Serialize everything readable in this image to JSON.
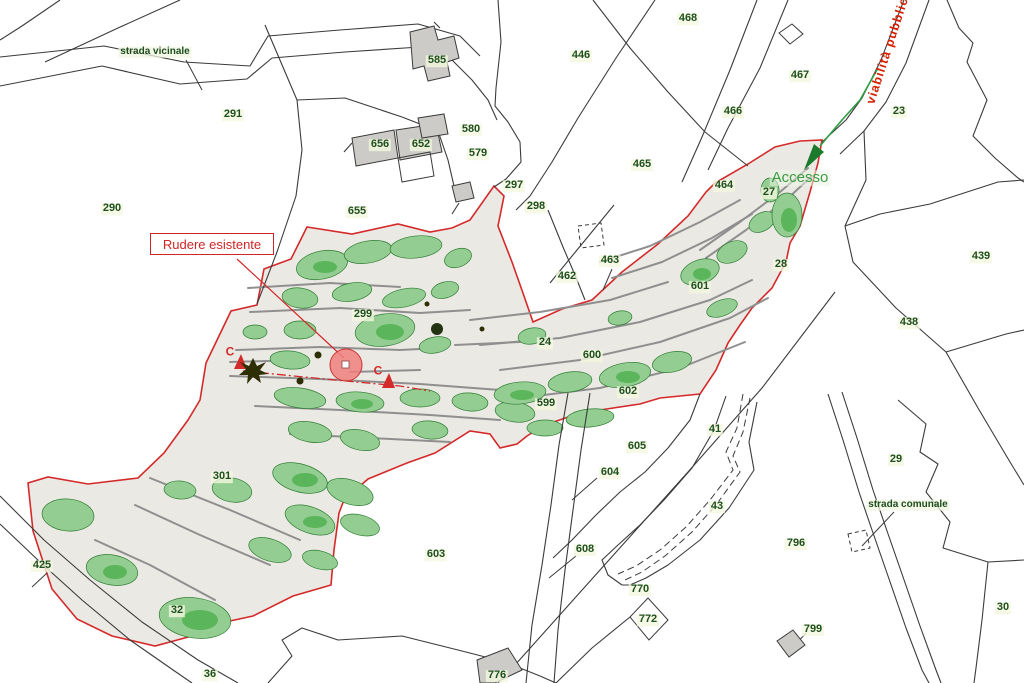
{
  "map": {
    "title": "cadastral-site-plan",
    "colors": {
      "site_boundary": "#d42a2a",
      "site_fill": "#ebe9e4",
      "vegetation": "#93cd92",
      "vegetation_dark": "#5bb55a",
      "parcel_line": "#3b3b3b",
      "terrace_wall": "#8f8f8f",
      "building_fill": "#cccbc7",
      "access_green": "#2f9e44",
      "ruin_marker_fill": "#f1807e"
    },
    "annotation": {
      "ruin_label": "Rudere esistente"
    },
    "labels": [
      {
        "text": "291",
        "x": 233,
        "y": 115,
        "cls": "parcel"
      },
      {
        "text": "290",
        "x": 112,
        "y": 209,
        "cls": "parcel"
      },
      {
        "text": "585",
        "x": 437,
        "y": 61,
        "cls": "parcel"
      },
      {
        "text": "656",
        "x": 380,
        "y": 145,
        "cls": "parcel"
      },
      {
        "text": "652",
        "x": 421,
        "y": 145,
        "cls": "parcel"
      },
      {
        "text": "580",
        "x": 471,
        "y": 130,
        "cls": "parcel"
      },
      {
        "text": "579",
        "x": 478,
        "y": 154,
        "cls": "parcel"
      },
      {
        "text": "297",
        "x": 514,
        "y": 186,
        "cls": "parcel"
      },
      {
        "text": "298",
        "x": 536,
        "y": 207,
        "cls": "parcel"
      },
      {
        "text": "655",
        "x": 357,
        "y": 212,
        "cls": "parcel"
      },
      {
        "text": "468",
        "x": 688,
        "y": 19,
        "cls": "parcel"
      },
      {
        "text": "446",
        "x": 581,
        "y": 56,
        "cls": "parcel"
      },
      {
        "text": "467",
        "x": 800,
        "y": 76,
        "cls": "parcel"
      },
      {
        "text": "466",
        "x": 733,
        "y": 112,
        "cls": "parcel"
      },
      {
        "text": "465",
        "x": 642,
        "y": 165,
        "cls": "parcel"
      },
      {
        "text": "23",
        "x": 899,
        "y": 112,
        "cls": "parcel"
      },
      {
        "text": "464",
        "x": 724,
        "y": 186,
        "cls": "parcel"
      },
      {
        "text": "27",
        "x": 769,
        "y": 193,
        "cls": "parcel"
      },
      {
        "text": "28",
        "x": 781,
        "y": 265,
        "cls": "parcel"
      },
      {
        "text": "439",
        "x": 981,
        "y": 257,
        "cls": "parcel"
      },
      {
        "text": "438",
        "x": 909,
        "y": 323,
        "cls": "parcel"
      },
      {
        "text": "462",
        "x": 567,
        "y": 277,
        "cls": "parcel"
      },
      {
        "text": "463",
        "x": 610,
        "y": 261,
        "cls": "parcel"
      },
      {
        "text": "601",
        "x": 700,
        "y": 287,
        "cls": "parcel"
      },
      {
        "text": "24",
        "x": 545,
        "y": 343,
        "cls": "parcel"
      },
      {
        "text": "600",
        "x": 592,
        "y": 356,
        "cls": "parcel"
      },
      {
        "text": "602",
        "x": 628,
        "y": 392,
        "cls": "parcel"
      },
      {
        "text": "599",
        "x": 546,
        "y": 404,
        "cls": "parcel"
      },
      {
        "text": "299",
        "x": 363,
        "y": 315,
        "cls": "parcel"
      },
      {
        "text": "41",
        "x": 715,
        "y": 430,
        "cls": "parcel"
      },
      {
        "text": "43",
        "x": 717,
        "y": 507,
        "cls": "parcel"
      },
      {
        "text": "605",
        "x": 637,
        "y": 447,
        "cls": "parcel"
      },
      {
        "text": "604",
        "x": 610,
        "y": 473,
        "cls": "parcel"
      },
      {
        "text": "608",
        "x": 585,
        "y": 550,
        "cls": "parcel"
      },
      {
        "text": "603",
        "x": 436,
        "y": 555,
        "cls": "parcel"
      },
      {
        "text": "301",
        "x": 222,
        "y": 477,
        "cls": "parcel"
      },
      {
        "text": "425",
        "x": 42,
        "y": 566,
        "cls": "parcel"
      },
      {
        "text": "32",
        "x": 177,
        "y": 611,
        "cls": "parcel"
      },
      {
        "text": "36",
        "x": 210,
        "y": 675,
        "cls": "parcel"
      },
      {
        "text": "29",
        "x": 896,
        "y": 460,
        "cls": "parcel"
      },
      {
        "text": "796",
        "x": 796,
        "y": 544,
        "cls": "parcel"
      },
      {
        "text": "770",
        "x": 640,
        "y": 590,
        "cls": "parcel"
      },
      {
        "text": "772",
        "x": 648,
        "y": 620,
        "cls": "parcel"
      },
      {
        "text": "799",
        "x": 813,
        "y": 630,
        "cls": "parcel"
      },
      {
        "text": "30",
        "x": 1003,
        "y": 608,
        "cls": "parcel"
      },
      {
        "text": "776",
        "x": 497,
        "y": 676,
        "cls": "parcel"
      },
      {
        "text": "strada vicinale",
        "x": 155,
        "y": 52,
        "cls": "road"
      },
      {
        "text": "strada comunale",
        "x": 908,
        "y": 505,
        "cls": "road"
      },
      {
        "text": "Accesso",
        "x": 800,
        "y": 178,
        "cls": "access"
      },
      {
        "text": "viabilità pubblica",
        "x": 889,
        "y": 47,
        "cls": "viabilita"
      },
      {
        "text": "C",
        "x": 230,
        "y": 352,
        "cls": "section"
      },
      {
        "text": "C",
        "x": 378,
        "y": 371,
        "cls": "section"
      }
    ]
  }
}
